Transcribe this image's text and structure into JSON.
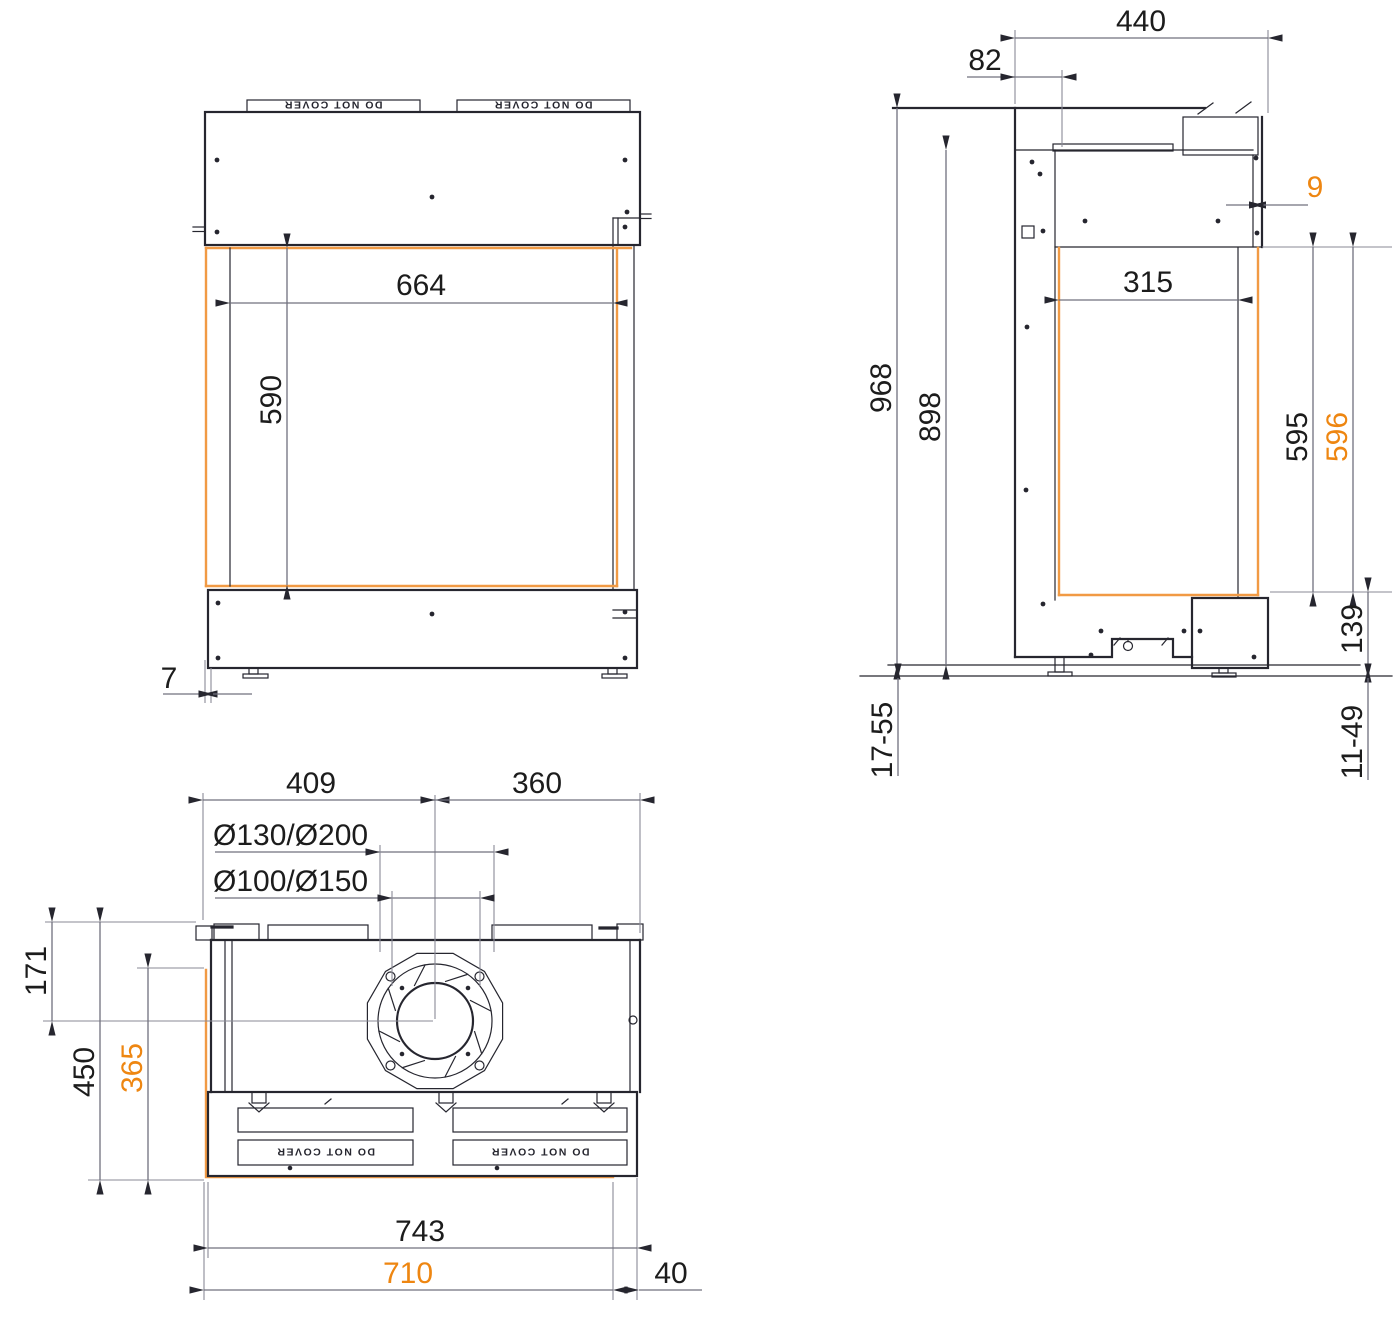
{
  "document": {
    "type": "technical-drawing",
    "subject": "built-in fireplace insert — dimensioned front, side and top views"
  },
  "colors": {
    "line": "#26262f",
    "dimension": "#70707e",
    "accent_line": "#f19a44",
    "accent_text": "#ee8611",
    "text": "#1c1c1c"
  },
  "labels": {
    "warning_plate": "DO NOT COVER"
  },
  "front_view": {
    "opening_width": "664",
    "opening_height": "590",
    "front_gap": "7"
  },
  "side_view": {
    "depth_overall": "440",
    "rear_offset": "82",
    "rear_panel_gap": "9",
    "height_overall": "968",
    "height_body": "898",
    "side_glass_depth": "315",
    "side_glass_height": "595",
    "side_glass_height_outer": "596",
    "plinth_height": "139",
    "floor_adjust_left": "17-55",
    "floor_adjust_right": "11-49"
  },
  "top_view": {
    "flue_offset_left": "409",
    "flue_offset_right": "360",
    "flue_diameters_outer": "Ø130/Ø200",
    "flue_diameters_inner": "Ø100/Ø150",
    "flue_offset_back": "171",
    "depth_total": "450",
    "side_glass_depth": "365",
    "width_front_panel": "743",
    "width_glass": "710",
    "side_gap": "40"
  }
}
